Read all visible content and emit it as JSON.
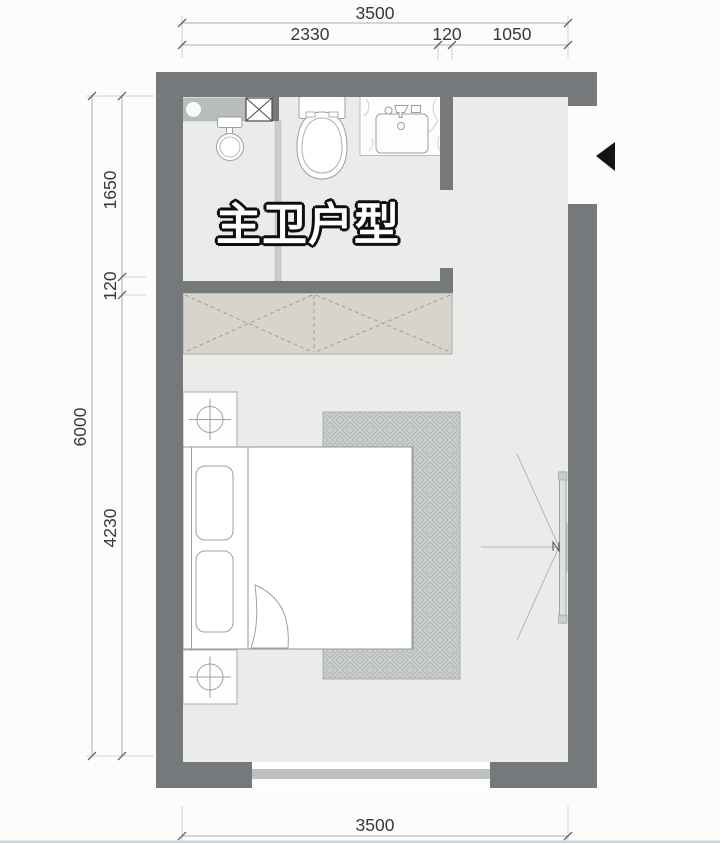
{
  "title": {
    "label": "主卫户型"
  },
  "plan": {
    "dimensions": {
      "top": {
        "total": "3500",
        "segments": [
          "2330",
          "120",
          "1050"
        ]
      },
      "left": {
        "total": "6000",
        "segments": [
          "1650",
          "120",
          "4230"
        ]
      },
      "bottom": {
        "total": "3500"
      }
    },
    "fixtures": {
      "bathroom": [
        "counter-basin",
        "duct-shaft",
        "round-washbasin",
        "toilet",
        "vanity-sink"
      ],
      "bedroom": [
        "wardrobe",
        "nightstand-lamp",
        "double-bed",
        "pillows",
        "duvet",
        "rug",
        "wall-tv"
      ],
      "entry": [
        "entrance-opening",
        "entrance-arrow",
        "window"
      ]
    },
    "colors": {
      "wall": "#75797c",
      "floor": "#ebebe9",
      "wardrobe_fill": "#d6d4cc",
      "wardrobe_dash": "#a89d92",
      "rug_fill": "#cbcfce",
      "rug_line": "#b1b7b5",
      "counter": "#b7bdb9",
      "window_band": "#bcc0bf",
      "fixture_outline": "#9aa0a0",
      "dimension_text": "#383838",
      "entrance_arrow": "#141414",
      "title_fill": "#ffffff",
      "title_outline": "#0e0e0e"
    }
  }
}
